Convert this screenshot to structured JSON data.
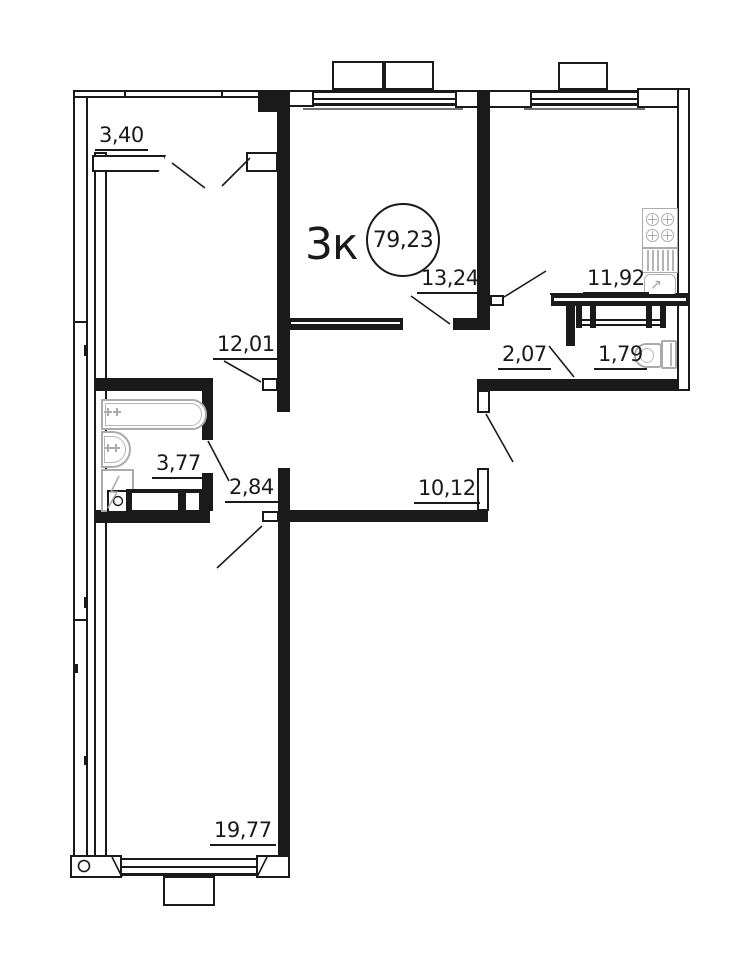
{
  "apartment": {
    "type_label": "3к",
    "total_area": "79,23"
  },
  "rooms": [
    {
      "name": "balcony",
      "area": "3,40"
    },
    {
      "name": "bedroom-1",
      "area": "12,01"
    },
    {
      "name": "living-room",
      "area": "13,24"
    },
    {
      "name": "kitchen",
      "area": "11,92"
    },
    {
      "name": "hallway",
      "area": "2,07"
    },
    {
      "name": "wc",
      "area": "1,79"
    },
    {
      "name": "bathroom",
      "area": "3,77"
    },
    {
      "name": "hall",
      "area": "2,84"
    },
    {
      "name": "corridor",
      "area": "10,12"
    },
    {
      "name": "bedroom-2",
      "area": "19,77"
    }
  ],
  "icons": {
    "sink_arrow": "↗"
  },
  "colors": {
    "line": "#1a1a1a",
    "fixture": "#ababab",
    "background": "#ffffff"
  }
}
